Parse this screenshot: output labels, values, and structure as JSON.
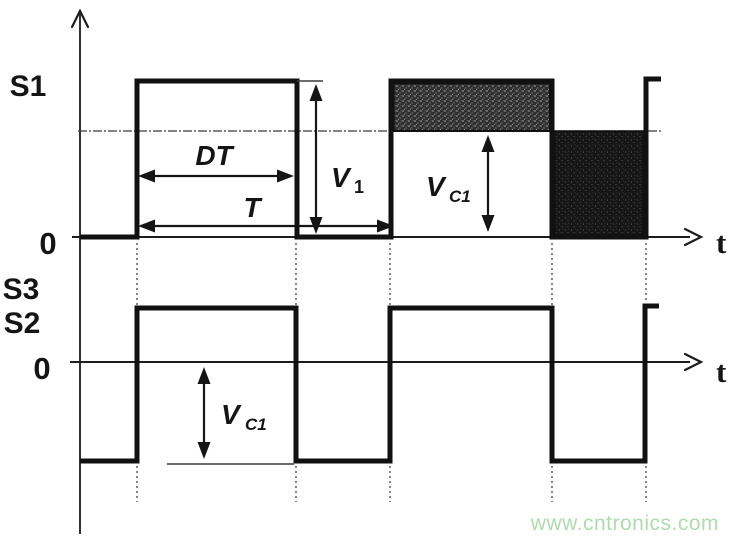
{
  "figure": {
    "watermark": "www.cntronics.com",
    "colors": {
      "ink": "#151515",
      "watermark_green": "#afdcaf",
      "background": "#ffffff",
      "shade_on_band": "#303030",
      "shade_off_block": "#161616"
    }
  },
  "top_plot": {
    "signal_label": "S1",
    "origin_label": "0",
    "time_label": "t",
    "duty_label": "DT",
    "period_label": "T",
    "v1": {
      "base": "V",
      "sub": "1"
    },
    "vc1": {
      "base": "V",
      "sub": "C1"
    }
  },
  "bottom_plot": {
    "signal_upper": "S3",
    "signal_lower": "S2",
    "origin_label": "0",
    "time_label": "t",
    "vc1": {
      "base": "V",
      "sub": "C1"
    }
  },
  "chart_data": {
    "type": "line",
    "title": "Switch timing waveforms (two periods shown)",
    "x_axis": "t",
    "period": "T",
    "on_interval": "DT",
    "signals": [
      {
        "name": "S1",
        "high_level": "V1",
        "low_level": "0",
        "steps": [
          {
            "from": "0",
            "to": "DT",
            "level": "V1"
          },
          {
            "from": "DT",
            "to": "T",
            "level": "0"
          }
        ],
        "reference_level": "VC1 (horizontal line between 0 and V1)",
        "shaded_regions": [
          "second period on-time: band between VC1 and V1 (speckled dark)",
          "second period off-time: block between 0 and VC1 (dark)"
        ]
      },
      {
        "name": "S3 / S2",
        "high_level": "positive (above 0, unlabeled)",
        "low_level": "-VC1",
        "steps": [
          {
            "from": "0",
            "to": "DT",
            "level": "high"
          },
          {
            "from": "DT",
            "to": "T",
            "level": "low"
          }
        ],
        "annotation": "VC1 double arrow spans from 0 axis down to the low level"
      }
    ]
  }
}
